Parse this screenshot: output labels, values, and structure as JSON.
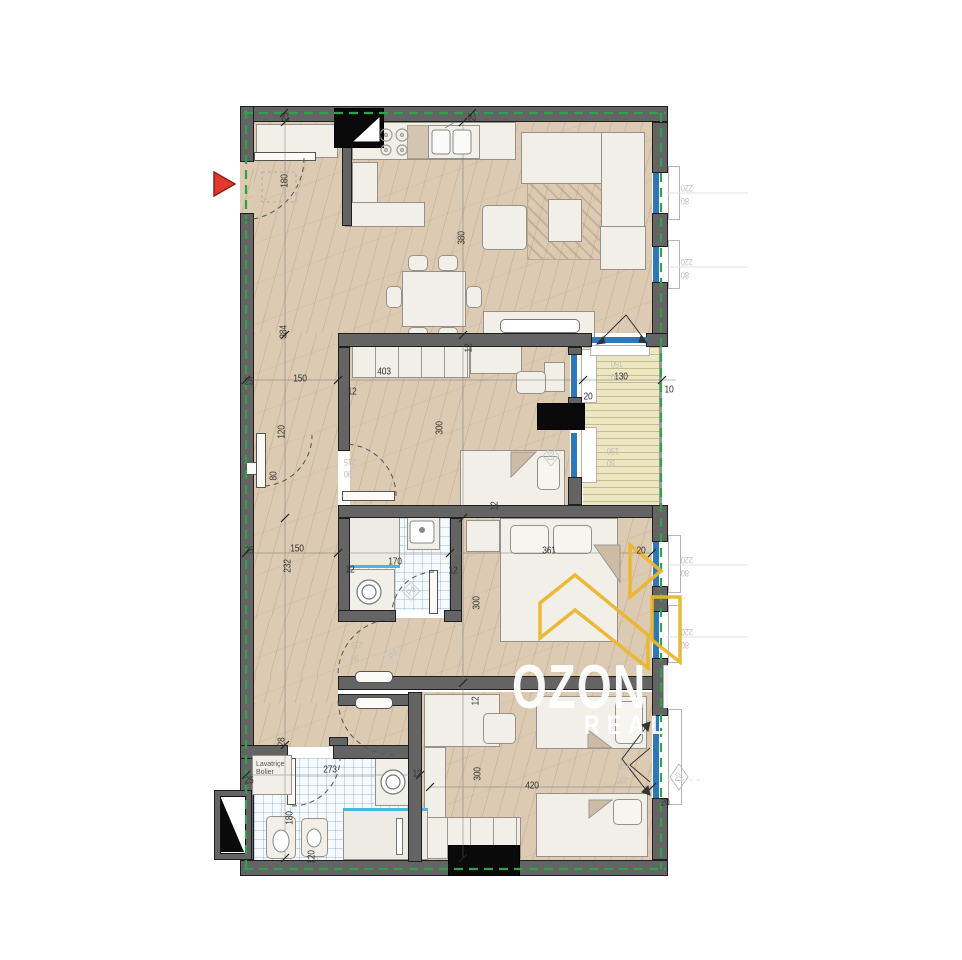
{
  "watermark": {
    "line1": "OZON LINE",
    "line2": "REAL ESTATE"
  },
  "utility_box": {
    "line1": "Lavatriçe",
    "line2": "Bolier"
  },
  "colors": {
    "wall_gray": "#646464",
    "floor_tan": "#dccab3",
    "balcony_yellow": "#ece6c3",
    "insulation_green": "#2ea34d",
    "window_blue": "#2e78b8",
    "marker_red": "#e2392f",
    "logo_yellow": "#eab72f",
    "dim_text": "#333333",
    "tag_text": "#bdbdbd"
  },
  "plan": {
    "labels": [
      {
        "t": "25",
        "x": 286,
        "y": 117,
        "r": -90
      },
      {
        "t": "25",
        "x": 473,
        "y": 117,
        "r": -90
      },
      {
        "t": "180",
        "x": 285,
        "y": 181,
        "r": -90
      },
      {
        "t": "380",
        "x": 462,
        "y": 238,
        "r": -90
      },
      {
        "t": "384",
        "x": 284,
        "y": 332,
        "r": -90
      },
      {
        "t": "25",
        "x": 249,
        "y": 382,
        "r": 0
      },
      {
        "t": "150",
        "x": 300,
        "y": 379,
        "r": 0
      },
      {
        "t": "12",
        "x": 352,
        "y": 392,
        "r": 0
      },
      {
        "t": "403",
        "x": 384,
        "y": 372,
        "r": 0
      },
      {
        "t": "12",
        "x": 469,
        "y": 348,
        "r": -90
      },
      {
        "t": "20",
        "x": 588,
        "y": 397,
        "r": 0
      },
      {
        "t": "130",
        "x": 621,
        "y": 377,
        "r": 0
      },
      {
        "t": "10",
        "x": 669,
        "y": 390,
        "r": 0
      },
      {
        "t": "300",
        "x": 440,
        "y": 428,
        "r": -90
      },
      {
        "t": "120",
        "x": 282,
        "y": 432,
        "r": -90
      },
      {
        "t": "80",
        "x": 274,
        "y": 476,
        "r": -90
      },
      {
        "t": "25",
        "x": 249,
        "y": 551,
        "r": 0
      },
      {
        "t": "150",
        "x": 297,
        "y": 549,
        "r": 0
      },
      {
        "t": "232",
        "x": 288,
        "y": 566,
        "r": -90
      },
      {
        "t": "170",
        "x": 395,
        "y": 562,
        "r": 0
      },
      {
        "t": "12",
        "x": 350,
        "y": 570,
        "r": 0
      },
      {
        "t": "12",
        "x": 453,
        "y": 571,
        "r": 0
      },
      {
        "t": "361",
        "x": 549,
        "y": 551,
        "r": 0
      },
      {
        "t": "20",
        "x": 641,
        "y": 551,
        "r": 0
      },
      {
        "t": "300",
        "x": 477,
        "y": 603,
        "r": -90
      },
      {
        "t": "12",
        "x": 495,
        "y": 506,
        "r": -90
      },
      {
        "t": "12",
        "x": 476,
        "y": 701,
        "r": -90
      },
      {
        "t": "420",
        "x": 532,
        "y": 786,
        "r": 0
      },
      {
        "t": "300",
        "x": 478,
        "y": 774,
        "r": -90
      },
      {
        "t": "25",
        "x": 249,
        "y": 781,
        "r": 0
      },
      {
        "t": "273",
        "x": 330,
        "y": 770,
        "r": 0
      },
      {
        "t": "28",
        "x": 282,
        "y": 742,
        "r": -90
      },
      {
        "t": "180",
        "x": 290,
        "y": 818,
        "r": -90
      },
      {
        "t": "12",
        "x": 417,
        "y": 774,
        "r": 0
      },
      {
        "t": "120",
        "x": 312,
        "y": 857,
        "r": -90
      },
      {
        "t": "20",
        "x": 665,
        "y": 803,
        "r": 0
      },
      {
        "t": "220",
        "x": 687,
        "y": 188,
        "r": 180,
        "cls": "tag"
      },
      {
        "t": "80",
        "x": 685,
        "y": 201,
        "r": 180,
        "cls": "tag"
      },
      {
        "t": "220",
        "x": 687,
        "y": 262,
        "r": 180,
        "cls": "tag"
      },
      {
        "t": "80",
        "x": 685,
        "y": 275,
        "r": 180,
        "cls": "tag"
      },
      {
        "t": "220",
        "x": 687,
        "y": 560,
        "r": 180,
        "cls": "tag"
      },
      {
        "t": "80",
        "x": 685,
        "y": 573,
        "r": 180,
        "cls": "tag"
      },
      {
        "t": "220",
        "x": 687,
        "y": 632,
        "r": 180,
        "cls": "tag"
      },
      {
        "t": "80",
        "x": 685,
        "y": 645,
        "r": 180,
        "cls": "tag"
      },
      {
        "t": "150",
        "x": 617,
        "y": 364,
        "r": 180,
        "cls": "tag"
      },
      {
        "t": "80",
        "x": 615,
        "y": 377,
        "r": 180,
        "cls": "tag"
      },
      {
        "t": "150",
        "x": 613,
        "y": 451,
        "r": 180,
        "cls": "tag"
      },
      {
        "t": "80",
        "x": 611,
        "y": 463,
        "r": 180,
        "cls": "tag"
      },
      {
        "t": "160",
        "x": 624,
        "y": 766,
        "r": 180,
        "cls": "tag"
      },
      {
        "t": "220",
        "x": 622,
        "y": 780,
        "r": 180,
        "cls": "tag"
      },
      {
        "t": "215",
        "x": 357,
        "y": 645,
        "r": 180,
        "cls": "tag"
      },
      {
        "t": "90",
        "x": 355,
        "y": 658,
        "r": 180,
        "cls": "tag"
      },
      {
        "t": "215",
        "x": 350,
        "y": 462,
        "r": 180,
        "cls": "tag"
      },
      {
        "t": "90",
        "x": 348,
        "y": 474,
        "r": 180,
        "cls": "tag"
      },
      {
        "t": "D2",
        "x": 679,
        "y": 777,
        "r": -90,
        "cls": "tag"
      },
      {
        "t": "Pd",
        "x": 411,
        "y": 591,
        "r": -45,
        "cls": "tag"
      },
      {
        "t": "Pd",
        "x": 393,
        "y": 655,
        "r": -45,
        "cls": "tag"
      },
      {
        "t": "D3",
        "x": 551,
        "y": 456,
        "r": -90,
        "cls": "tag"
      }
    ]
  }
}
